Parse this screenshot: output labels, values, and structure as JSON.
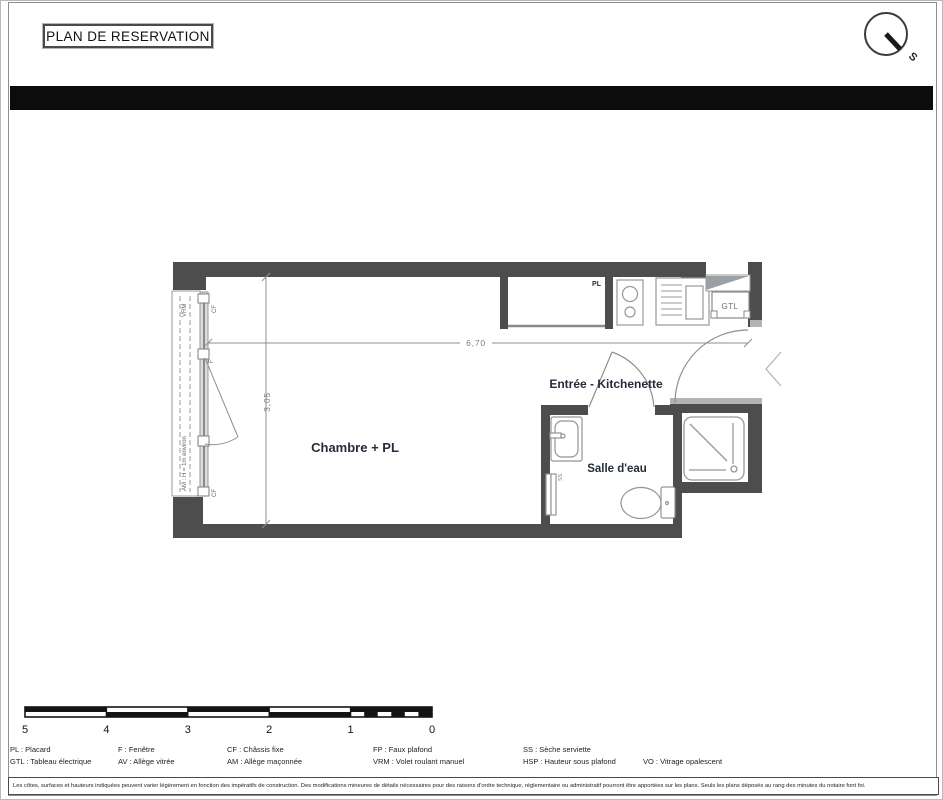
{
  "page": {
    "title": "PLAN DE RESERVATION",
    "disclaimer": "Les côtes, surfaces et hauteurs indiquées peuvent varier légèrement en fonction des impératifs de construction. Des modifications mineures de détails nécessaires pour des raisons d'ordre technique, réglementaire ou administratif pourront être apportées sur les plans. Seuls les plans déposés au rang des minutes du notaire font foi."
  },
  "north": {
    "label": "S"
  },
  "plan": {
    "rooms": {
      "chambre": "Chambre + PL",
      "entree": "Entrée - Kitchenette",
      "salle_eau": "Salle d'eau"
    },
    "labels": {
      "pl": "PL",
      "gtl": "GTL",
      "vrm": "VRM",
      "cf_top": "CF",
      "f": "F",
      "cf_bottom": "CF",
      "am": "AM : H = 1m environ",
      "ss": "SS"
    },
    "dimensions": {
      "width": "6,70",
      "height": "3,05"
    }
  },
  "scale_bar": {
    "labels": [
      "5",
      "4",
      "3",
      "2",
      "1",
      "0"
    ]
  },
  "legend": {
    "columns": [
      {
        "lines": [
          "PL : Placard",
          "GTL : Tableau électrique"
        ]
      },
      {
        "lines": [
          "F : Fenêtre",
          "AV : Allège vitrée"
        ]
      },
      {
        "lines": [
          "CF : Châssis fixe",
          "AM : Allège maçonnée"
        ]
      },
      {
        "lines": [
          "FP : Faux plafond",
          "VRM : Volet roulant manuel"
        ]
      },
      {
        "lines": [
          "SS : Sèche serviette",
          "HSP : Hauteur sous plafond"
        ]
      },
      {
        "lines": [
          "",
          "VO : Vitrage opalescent"
        ]
      }
    ]
  },
  "colors": {
    "wall": "#4d4d4d",
    "wall_light": "#b3b3b3",
    "fixture_line": "#989898",
    "dimension_line": "#8f8f8f",
    "room_label": "#242c3a"
  }
}
